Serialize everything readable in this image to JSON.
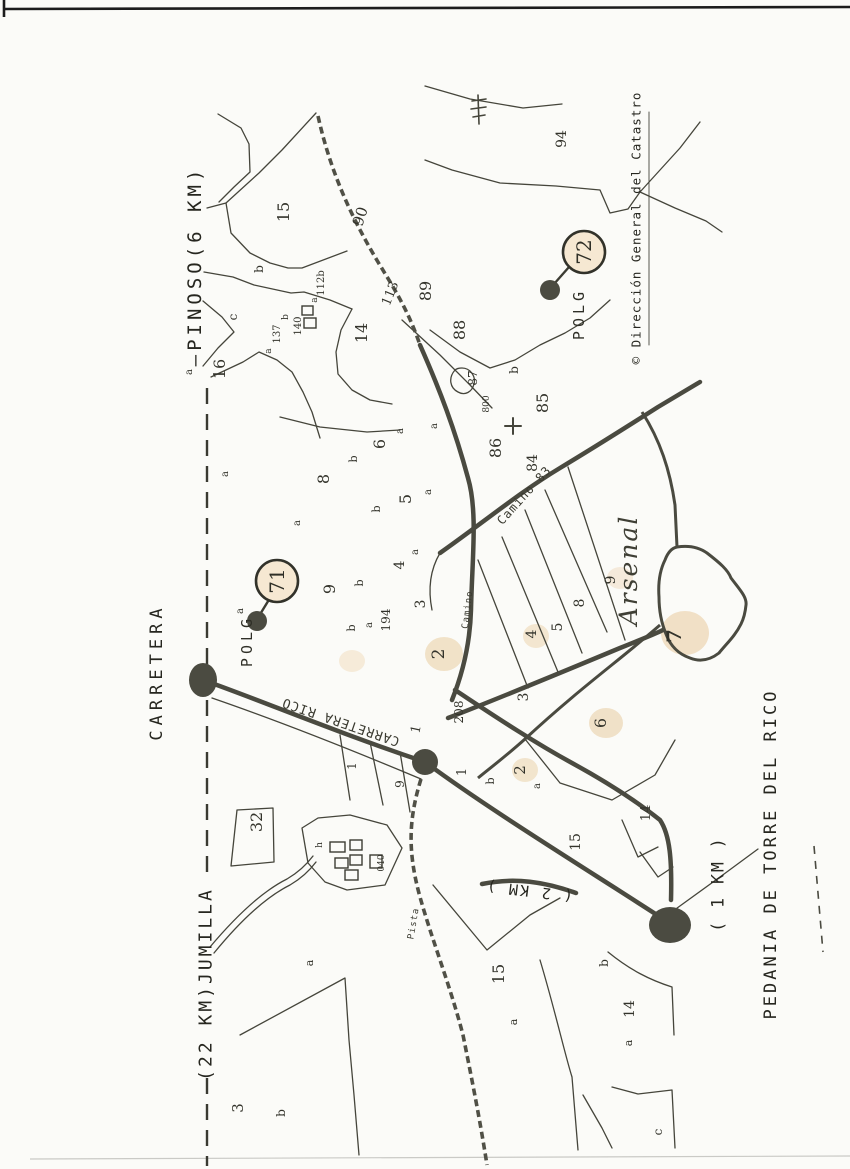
{
  "peripheral_labels": {
    "carretera_road_name": "CARRETERA",
    "pinoso_direction": "—PINOSO(6 KM)",
    "jumilla_direction": "(22 KM)JUMILLA",
    "pedania_caption": "PEDANIA DE TORRE DEL RICO",
    "distance_1km": "( 1 KM )",
    "distance_2km": "( 2 KM )",
    "copyright": "© Dirección General del Catastro"
  },
  "polygon_markers": [
    {
      "name": "POLG",
      "number": "71",
      "cx": 277,
      "cy": 581,
      "r": 21,
      "tx": 252,
      "ty": 641,
      "dx": 257,
      "dy": 621,
      "lx1": 259,
      "ly1": 616,
      "lx2": 270,
      "ly2": 598
    },
    {
      "name": "POLG",
      "number": "72",
      "cx": 584,
      "cy": 252,
      "r": 21,
      "tx": 584,
      "ty": 314,
      "dx": 550,
      "dy": 290,
      "lx1": 554,
      "ly1": 284,
      "lx2": 569,
      "ly2": 267
    }
  ],
  "road_labels": [
    {
      "text": "CARRETERA RICO",
      "x": 342,
      "y": 718,
      "r": 199,
      "s": 13
    },
    {
      "text": "Camino 83",
      "x": 527,
      "y": 498,
      "r": -48,
      "s": 12
    },
    {
      "text": "Camino",
      "x": 470,
      "y": 610,
      "r": -83,
      "s": 9
    },
    {
      "text": "Pista",
      "x": 416,
      "y": 924,
      "r": -80,
      "s": 9
    }
  ],
  "place_labels": [
    {
      "text": "Arsenal",
      "x": 637,
      "y": 570,
      "r": -90,
      "s": 25
    }
  ],
  "parcel_labels": [
    {
      "t": "15",
      "x": 289,
      "y": 212
    },
    {
      "t": "b",
      "x": 263,
      "y": 269,
      "s": 12
    },
    {
      "t": "c",
      "x": 237,
      "y": 317,
      "s": 12
    },
    {
      "t": "16",
      "x": 225,
      "y": 369
    },
    {
      "t": "a",
      "x": 192,
      "y": 372,
      "s": 10
    },
    {
      "t": "a",
      "x": 271,
      "y": 351,
      "s": 9
    },
    {
      "t": "137",
      "x": 280,
      "y": 334,
      "s": 10
    },
    {
      "t": "b",
      "x": 288,
      "y": 317,
      "s": 9
    },
    {
      "t": "140",
      "x": 301,
      "y": 326,
      "s": 10
    },
    {
      "t": "a",
      "x": 317,
      "y": 300,
      "s": 9
    },
    {
      "t": "112b",
      "x": 324,
      "y": 283,
      "s": 10
    },
    {
      "t": "14",
      "x": 367,
      "y": 333
    },
    {
      "t": "113",
      "x": 394,
      "y": 295,
      "r": -68,
      "s": 13
    },
    {
      "t": "90",
      "x": 365,
      "y": 218,
      "r": -72,
      "s": 15
    },
    {
      "t": "94",
      "x": 566,
      "y": 139,
      "s": 14
    },
    {
      "t": "89",
      "x": 431,
      "y": 291
    },
    {
      "t": "88",
      "x": 465,
      "y": 330
    },
    {
      "t": "87",
      "x": 477,
      "y": 378,
      "s": 12
    },
    {
      "t": "800",
      "x": 489,
      "y": 404,
      "s": 9
    },
    {
      "t": "b",
      "x": 518,
      "y": 370,
      "s": 12
    },
    {
      "t": "86",
      "x": 501,
      "y": 448
    },
    {
      "t": "85",
      "x": 548,
      "y": 403
    },
    {
      "t": "84",
      "x": 537,
      "y": 463,
      "s": 14
    },
    {
      "t": "a",
      "x": 437,
      "y": 426,
      "s": 10
    },
    {
      "t": "a",
      "x": 431,
      "y": 492,
      "s": 10
    },
    {
      "t": "a",
      "x": 228,
      "y": 474,
      "s": 10
    },
    {
      "t": "8",
      "x": 329,
      "y": 479
    },
    {
      "t": "b",
      "x": 357,
      "y": 459,
      "s": 11
    },
    {
      "t": "6",
      "x": 385,
      "y": 444
    },
    {
      "t": "a",
      "x": 403,
      "y": 431,
      "s": 10
    },
    {
      "t": "5",
      "x": 411,
      "y": 499
    },
    {
      "t": "b",
      "x": 380,
      "y": 509,
      "s": 11
    },
    {
      "t": "a",
      "x": 300,
      "y": 523,
      "s": 10
    },
    {
      "t": "4",
      "x": 404,
      "y": 565,
      "s": 14
    },
    {
      "t": "a",
      "x": 418,
      "y": 552,
      "s": 10
    },
    {
      "t": "9",
      "x": 335,
      "y": 589
    },
    {
      "t": "b",
      "x": 363,
      "y": 583,
      "s": 11
    },
    {
      "t": "a",
      "x": 243,
      "y": 611,
      "s": 10
    },
    {
      "t": "b",
      "x": 355,
      "y": 628,
      "s": 11
    },
    {
      "t": "a",
      "x": 372,
      "y": 625,
      "s": 10
    },
    {
      "t": "194",
      "x": 390,
      "y": 620,
      "s": 12
    },
    {
      "t": "3",
      "x": 425,
      "y": 604,
      "s": 14
    },
    {
      "t": "2",
      "x": 444,
      "y": 654,
      "s": 17
    },
    {
      "t": "208",
      "x": 463,
      "y": 712,
      "s": 12
    },
    {
      "t": "1",
      "x": 420,
      "y": 730,
      "r": -78,
      "s": 13
    },
    {
      "t": "1",
      "x": 356,
      "y": 766,
      "s": 12
    },
    {
      "t": "9",
      "x": 404,
      "y": 784,
      "s": 12
    },
    {
      "t": "1",
      "x": 466,
      "y": 772,
      "s": 13
    },
    {
      "t": "b",
      "x": 494,
      "y": 781,
      "s": 11
    },
    {
      "t": "2",
      "x": 525,
      "y": 770,
      "s": 15
    },
    {
      "t": "a",
      "x": 540,
      "y": 786,
      "s": 10
    },
    {
      "t": "3",
      "x": 528,
      "y": 697,
      "s": 14
    },
    {
      "t": "4",
      "x": 536,
      "y": 634,
      "s": 14
    },
    {
      "t": "5",
      "x": 562,
      "y": 627,
      "s": 14
    },
    {
      "t": "8",
      "x": 584,
      "y": 603,
      "s": 14
    },
    {
      "t": "9",
      "x": 615,
      "y": 580,
      "s": 14
    },
    {
      "t": "7",
      "x": 681,
      "y": 636,
      "s": 20,
      "b": true
    },
    {
      "t": "6",
      "x": 606,
      "y": 723,
      "s": 16
    },
    {
      "t": "32",
      "x": 262,
      "y": 822
    },
    {
      "t": "h",
      "x": 322,
      "y": 845,
      "s": 9
    },
    {
      "t": "040",
      "x": 384,
      "y": 863,
      "s": 9
    },
    {
      "t": "a",
      "x": 313,
      "y": 963,
      "s": 11
    },
    {
      "t": "3",
      "x": 243,
      "y": 1108,
      "s": 15
    },
    {
      "t": "b",
      "x": 285,
      "y": 1113,
      "s": 12
    },
    {
      "t": "15",
      "x": 504,
      "y": 974
    },
    {
      "t": "a",
      "x": 517,
      "y": 1022,
      "s": 11
    },
    {
      "t": "15",
      "x": 580,
      "y": 842,
      "s": 14
    },
    {
      "t": "14",
      "x": 650,
      "y": 813,
      "s": 13
    },
    {
      "t": "b",
      "x": 608,
      "y": 963,
      "s": 12
    },
    {
      "t": "14",
      "x": 634,
      "y": 1009,
      "s": 14
    },
    {
      "t": "a",
      "x": 632,
      "y": 1043,
      "s": 11
    },
    {
      "t": "c",
      "x": 662,
      "y": 1132,
      "s": 12
    }
  ]
}
